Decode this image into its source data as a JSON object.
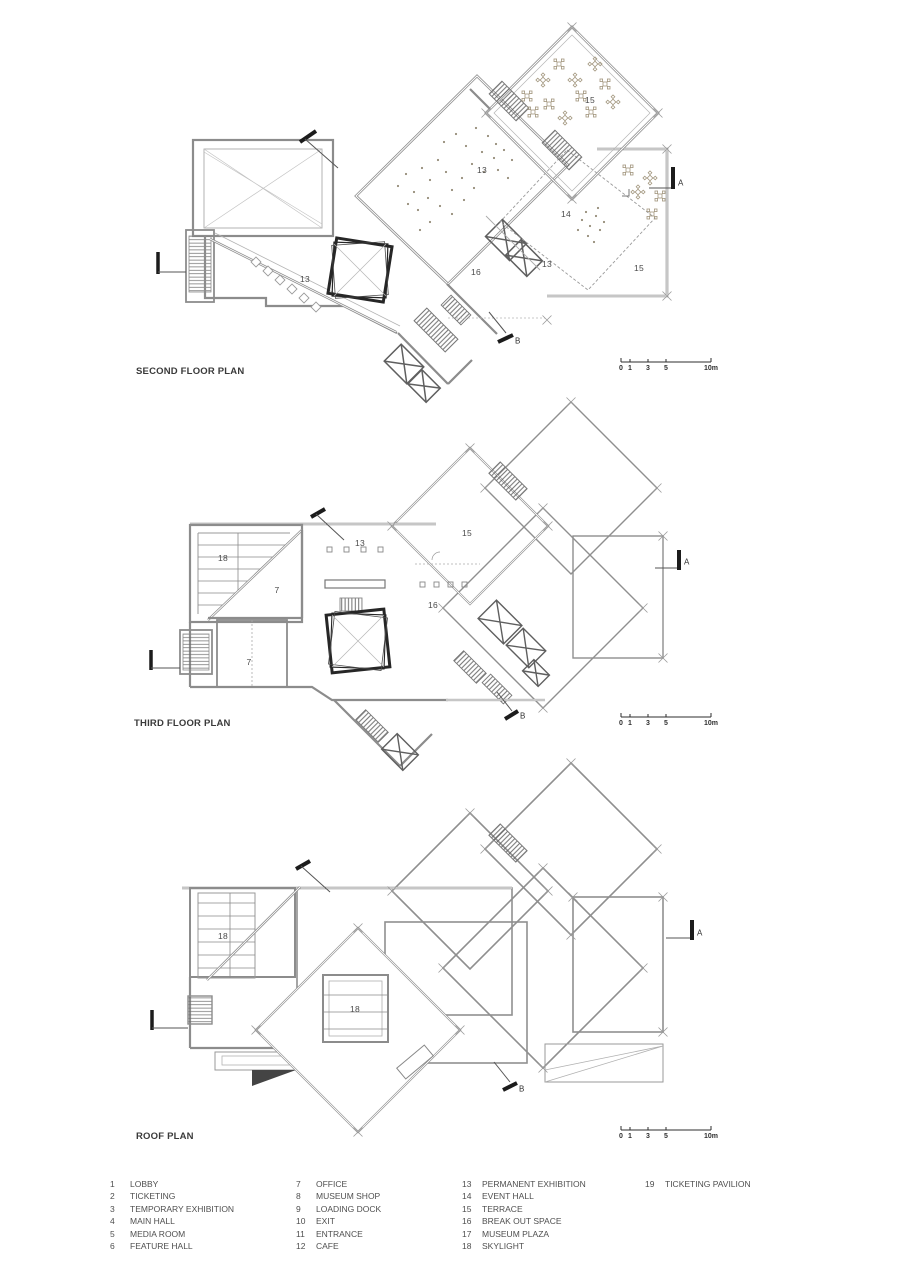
{
  "document": {
    "kind": "museum floor plan sheet",
    "accent_color": "#8c8c8c",
    "mark_color": "#1c1c1c"
  },
  "plans": [
    {
      "title": "SECOND FLOOR PLAN",
      "labels": [
        "13",
        "15",
        "14",
        "13",
        "15",
        "16",
        "13"
      ],
      "section_a": "A",
      "section_b": "B"
    },
    {
      "title": "THIRD FLOOR PLAN",
      "labels": [
        "18",
        "13",
        "15",
        "7",
        "16",
        "7"
      ],
      "section_a": "A",
      "section_b": "B"
    },
    {
      "title": "ROOF PLAN",
      "labels": [
        "18",
        "18"
      ],
      "section_a": "A",
      "section_b": "B"
    }
  ],
  "scale_bar": {
    "labels": [
      "0",
      "1",
      "3",
      "5",
      "10m"
    ]
  },
  "legend": {
    "columns": [
      {
        "rows": [
          {
            "n": "1",
            "t": "LOBBY"
          },
          {
            "n": "2",
            "t": "TICKETING"
          },
          {
            "n": "3",
            "t": "TEMPORARY EXHIBITION"
          },
          {
            "n": "4",
            "t": "MAIN HALL"
          },
          {
            "n": "5",
            "t": "MEDIA ROOM"
          },
          {
            "n": "6",
            "t": "FEATURE HALL"
          }
        ]
      },
      {
        "rows": [
          {
            "n": "7",
            "t": "OFFICE"
          },
          {
            "n": "8",
            "t": "MUSEUM SHOP"
          },
          {
            "n": "9",
            "t": "LOADING DOCK"
          },
          {
            "n": "10",
            "t": "EXIT"
          },
          {
            "n": "11",
            "t": "ENTRANCE"
          },
          {
            "n": "12",
            "t": "CAFE"
          }
        ]
      },
      {
        "rows": [
          {
            "n": "13",
            "t": "PERMANENT EXHIBITION"
          },
          {
            "n": "14",
            "t": "EVENT HALL"
          },
          {
            "n": "15",
            "t": "TERRACE"
          },
          {
            "n": "16",
            "t": "BREAK OUT SPACE"
          },
          {
            "n": "17",
            "t": "MUSEUM PLAZA"
          },
          {
            "n": "18",
            "t": "SKYLIGHT"
          }
        ]
      },
      {
        "rows": [
          {
            "n": "19",
            "t": "TICKETING PAVILION"
          }
        ]
      }
    ]
  }
}
